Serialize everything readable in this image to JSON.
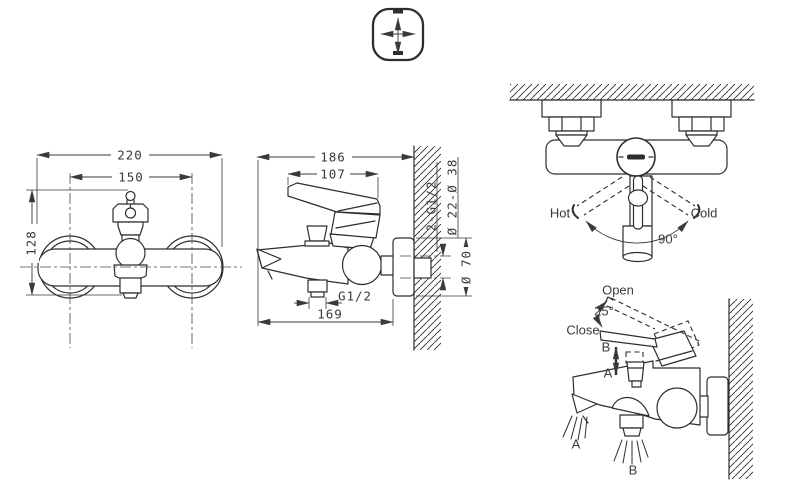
{
  "colors": {
    "line": "#2e2e2e",
    "text": "#3a3a3a",
    "background": "#ffffff"
  },
  "front": {
    "width": "220",
    "spacing": "150",
    "height": "128"
  },
  "side": {
    "depth": "186",
    "lever": "107",
    "outlet_thread": "G1/2",
    "spout_depth": "169",
    "inlet_threads": "2-G1/2",
    "cover_range": "Ø 22-Ø 38",
    "flange_diameter": "Ø 70"
  },
  "rotation": {
    "hot": "Hot",
    "cold": "Cold",
    "angle": "90°"
  },
  "operation": {
    "open": "Open",
    "close": "Close",
    "angle": "25°",
    "pull": "B",
    "push": "A",
    "spout_flow": "A",
    "shower_flow": "B"
  }
}
